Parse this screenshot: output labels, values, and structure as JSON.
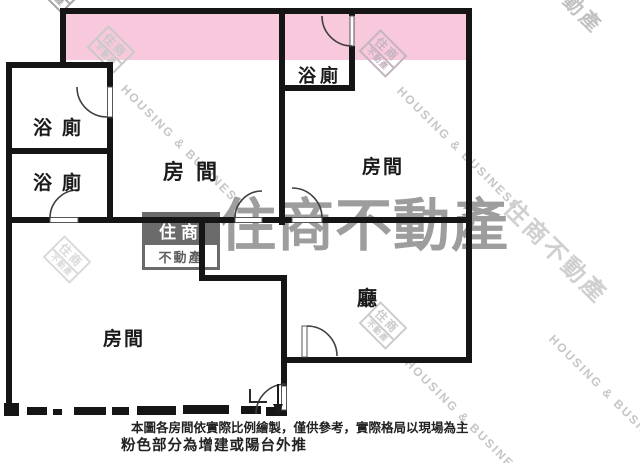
{
  "plan": {
    "rooms": {
      "bath_upper_left": "浴廁",
      "bath_lower_left": "浴廁",
      "bath_top": "浴廁",
      "bedroom_middle": "房間",
      "bedroom_right": "房間",
      "bedroom_bottom": "房間",
      "living": "廳"
    }
  },
  "watermark": {
    "logo_top": "住商",
    "logo_bottom": "不動產",
    "brand_cjk": "住商不動產",
    "brand_en": "HOUSING & BUSINESS",
    "corner_fragment": "動產"
  },
  "footnote": {
    "line1": "本圖各房間依實際比例繪製，僅供參考，實際格局以現場為主",
    "line2": "粉色部分為增建或陽台外推"
  },
  "colors": {
    "pink": "#F8C8DC",
    "wall": "#151515",
    "watermark_gray": "#9d9d9d",
    "watermark_light": "#c9c9c9"
  }
}
